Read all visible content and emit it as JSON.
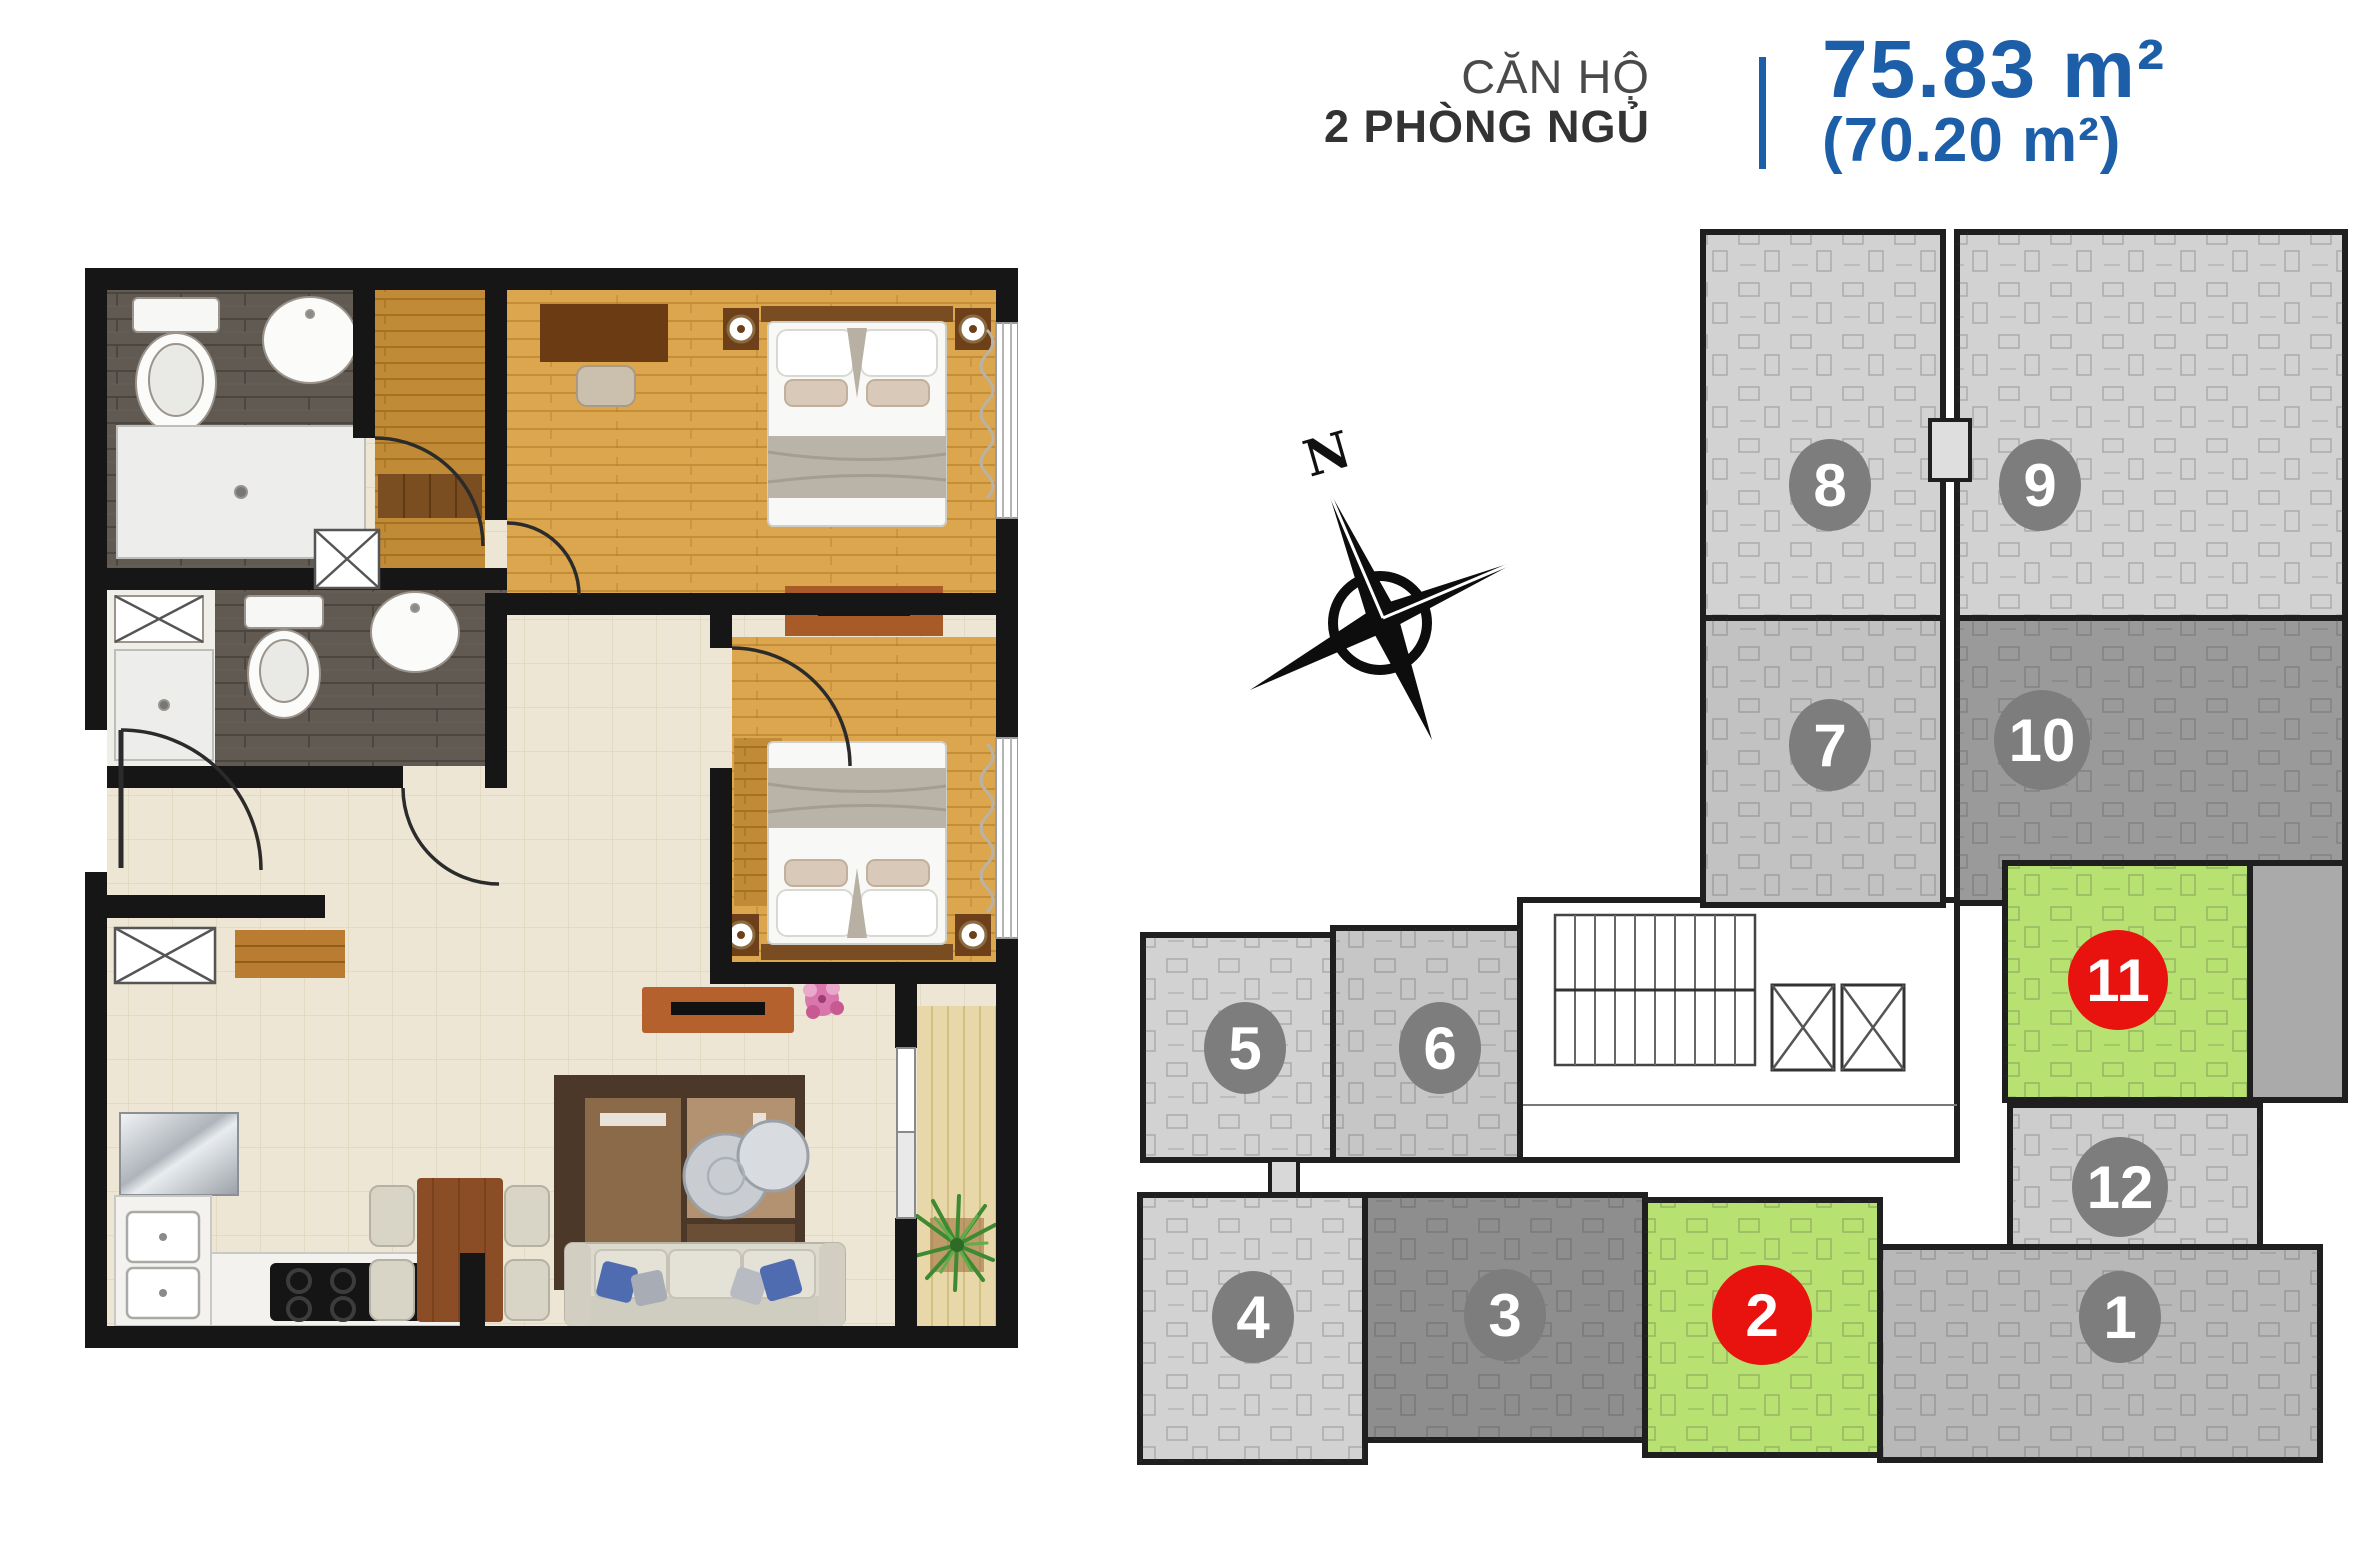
{
  "header": {
    "label_line1": "CĂN HỘ",
    "label_line2": "2 PHÒNG NGỦ",
    "area_primary": "75.83 m²",
    "area_secondary": "(70.20 m²)",
    "accent_color": "#1c5fa8",
    "label_color": "#4a4a4a"
  },
  "compass": {
    "label": "N"
  },
  "site_plan": {
    "highlight_color": "#b7e170",
    "badge_default_color": "#7d7d7d",
    "badge_highlight_color": "#e8120e",
    "wall_color": "#1f1f1f",
    "units": [
      {
        "number": "1",
        "highlighted": false,
        "fill": "#b8b8b8",
        "badge_color": "#7d7d7d"
      },
      {
        "number": "2",
        "highlighted": true,
        "fill": "#b7e170",
        "badge_color": "#e8120e"
      },
      {
        "number": "3",
        "highlighted": false,
        "fill": "#8e8e8e",
        "badge_color": "#7d7d7d"
      },
      {
        "number": "4",
        "highlighted": false,
        "fill": "#d2d2d2",
        "badge_color": "#7d7d7d"
      },
      {
        "number": "5",
        "highlighted": false,
        "fill": "#d2d2d2",
        "badge_color": "#7d7d7d"
      },
      {
        "number": "6",
        "highlighted": false,
        "fill": "#c6c6c6",
        "badge_color": "#7d7d7d"
      },
      {
        "number": "7",
        "highlighted": false,
        "fill": "#c2c2c2",
        "badge_color": "#7d7d7d"
      },
      {
        "number": "8",
        "highlighted": false,
        "fill": "#d2d2d2",
        "badge_color": "#7d7d7d"
      },
      {
        "number": "9",
        "highlighted": false,
        "fill": "#d2d2d2",
        "badge_color": "#7d7d7d"
      },
      {
        "number": "10",
        "highlighted": false,
        "fill": "#9a9a9a",
        "badge_color": "#7d7d7d"
      },
      {
        "number": "11",
        "highlighted": true,
        "fill": "#b7e170",
        "badge_color": "#e8120e"
      },
      {
        "number": "12",
        "highlighted": false,
        "fill": "#cdcdcd",
        "badge_color": "#7d7d7d"
      }
    ]
  },
  "floor_plan": {
    "palette": {
      "wall": "#161616",
      "wood_floor": "#dca64e",
      "wood_dark": "#c08a36",
      "tile_floor": "#eee6d4",
      "bath_tile": "#615a52",
      "balcony_floor": "#e7d7a9",
      "sofa": "#dcd9cd",
      "pillow_blue": "#4f6cb0",
      "rug": "#4c3828",
      "table_wood": "#8a4d26",
      "tv_console": "#b4612e",
      "plant_green": "#3e8a32",
      "flower_pink": "#d977ac"
    }
  }
}
